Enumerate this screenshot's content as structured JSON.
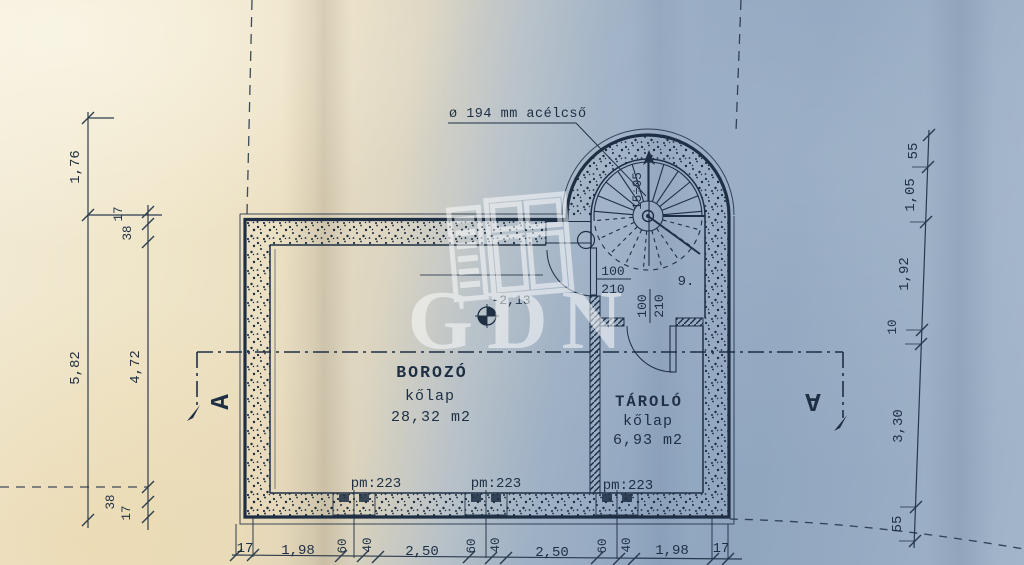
{
  "plan": {
    "pipe_note": "ø 194 mm acélcső",
    "level_marker": "-2,13",
    "stair_run_label": "15÷05",
    "step_number": "9.",
    "section_marker": "A",
    "watermark": "GDN",
    "rooms": [
      {
        "name": "BOROZÓ",
        "finish": "kőlap",
        "area": "28,32 m2"
      },
      {
        "name": "TÁROLÓ",
        "finish": "kőlap",
        "area": "6,93 m2"
      }
    ],
    "plinth_labels": [
      "pm:223",
      "pm:223",
      "pm:223"
    ],
    "door_size": {
      "width": "100",
      "height": "210"
    },
    "dims": {
      "left_outer": [
        "1,76",
        "5,82"
      ],
      "left_inner": [
        "17",
        "38",
        "4,72",
        "38",
        "17"
      ],
      "right": [
        "55",
        "1,05",
        "1,92",
        "10",
        "3,30",
        "55"
      ],
      "bottom": [
        "17",
        "1,98",
        "60",
        "40",
        "2,50",
        "60",
        "40",
        "2,50",
        "60",
        "40",
        "1,98",
        "17"
      ]
    }
  }
}
